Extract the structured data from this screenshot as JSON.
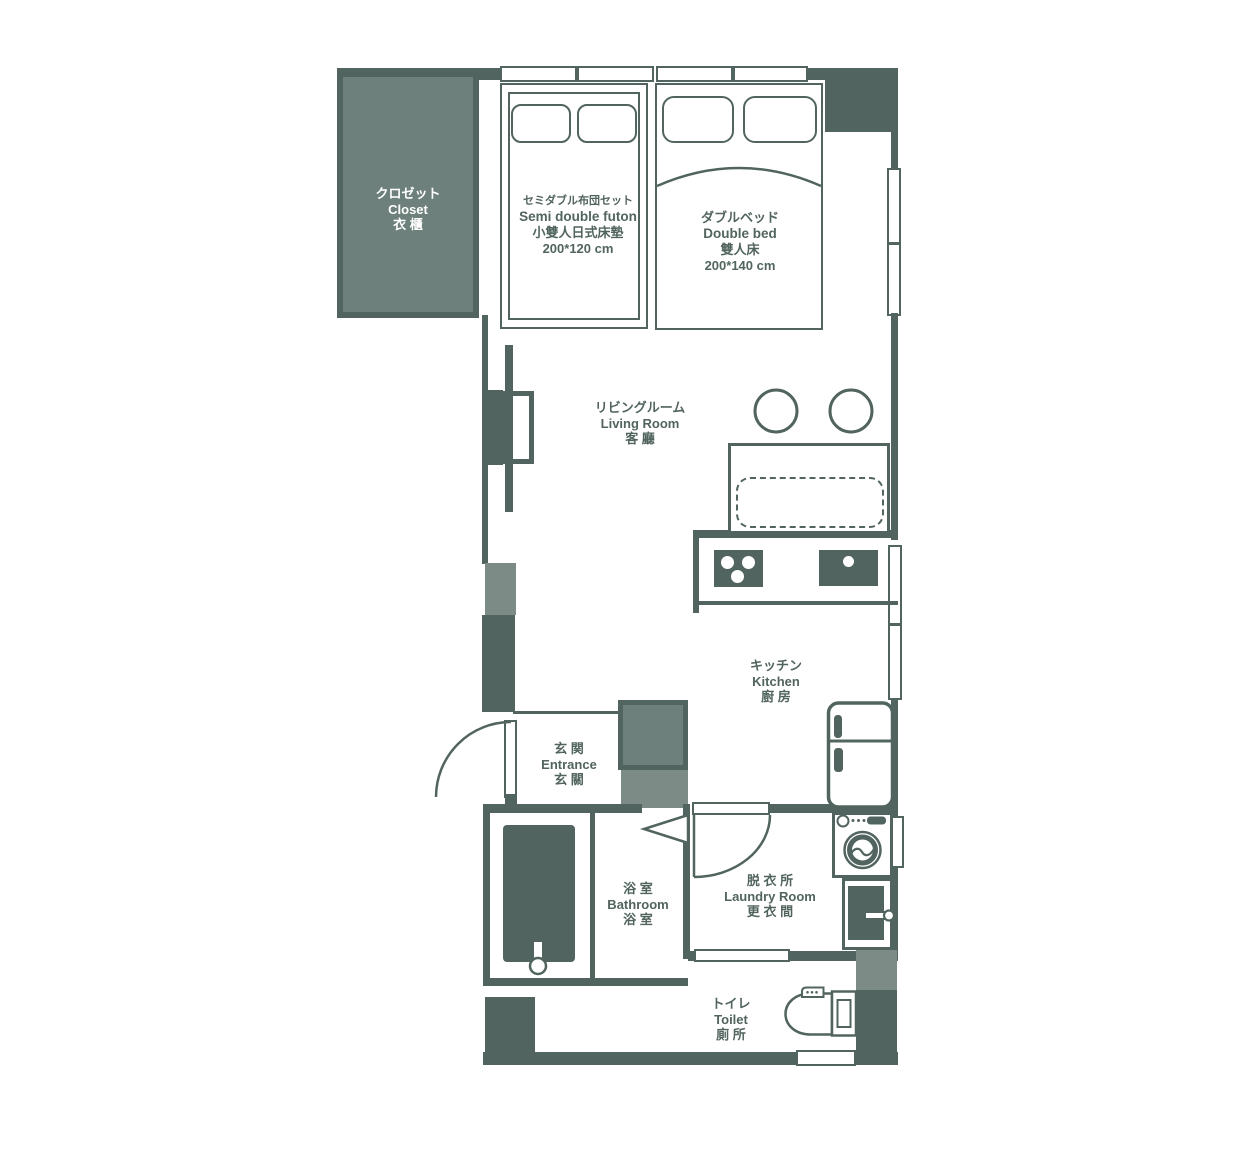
{
  "colors": {
    "wall": "#52645f",
    "fill": "#6e807b",
    "fill_light": "#7c8b86",
    "background": "#ffffff",
    "text": "#52645f",
    "label_on_fill": "#ffffff"
  },
  "rooms": {
    "closet": {
      "lines": [
        "クロゼット",
        "Closet",
        "衣 櫃"
      ]
    },
    "living": {
      "lines": [
        "リビングルーム",
        "Living Room",
        "客 廳"
      ]
    },
    "kitchen": {
      "lines": [
        "キッチン",
        "Kitchen",
        "廚 房"
      ]
    },
    "entrance": {
      "lines": [
        "玄 関",
        "Entrance",
        "玄 關"
      ]
    },
    "bathroom": {
      "lines": [
        "浴 室",
        "Bathroom",
        "浴 室"
      ]
    },
    "laundry": {
      "lines": [
        "脱 衣 所",
        "Laundry Room",
        "更 衣 間"
      ]
    },
    "toilet": {
      "lines": [
        "トイレ",
        "Toilet",
        "廁 所"
      ]
    }
  },
  "furniture": {
    "futon": {
      "lines": [
        "セミダブル布団セット",
        "Semi double futon",
        "小雙人日式床墊",
        "200*120 cm"
      ]
    },
    "double_bed": {
      "lines": [
        "ダブルベッド",
        "Double bed",
        "雙人床",
        "200*140 cm"
      ]
    }
  },
  "icons": {
    "stool": "circle-outline",
    "stove": "three-burner-cooktop",
    "sink": "basin-with-drain-dot",
    "refrigerator": "two-door-fridge",
    "washing_machine": "front-load-washer",
    "bathtub": "filled-tub-with-faucet",
    "toilet": "tank-toilet-top-view",
    "tv": "wall-mounted-tv",
    "swing_door": "quarter-arc-swing",
    "folding_door": "triangle-bifold",
    "window": "double-pane-strip"
  }
}
